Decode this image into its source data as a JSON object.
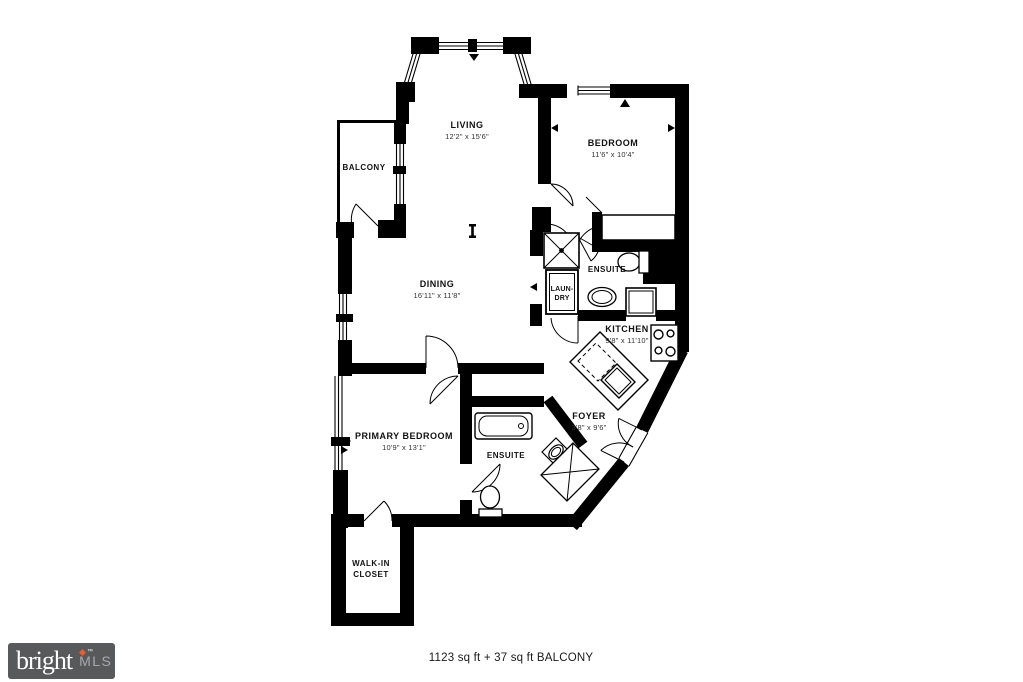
{
  "colors": {
    "wall": "#000000",
    "background": "#ffffff",
    "logo_bg": "#58595b",
    "logo_accent": "#ef5b2c",
    "logo_mls": "#a7a9ac"
  },
  "logo": {
    "brand": "bright",
    "tm": "™",
    "suffix": "MLS"
  },
  "footer": {
    "area_text": "1123 sq ft + 37 sq ft BALCONY"
  },
  "rooms": {
    "living": {
      "name": "LIVING",
      "dims": "12'2\" x 15'6\""
    },
    "balcony": {
      "name": "BALCONY"
    },
    "bedroom": {
      "name": "BEDROOM",
      "dims": "11'6\" x 10'4\""
    },
    "dining": {
      "name": "DINING",
      "dims": "16'11\" x 11'8\""
    },
    "ensuite_upper": {
      "name": "ENSUITE"
    },
    "laundry": {
      "name_line1": "LAUN-",
      "name_line2": "DRY"
    },
    "kitchen": {
      "name": "KITCHEN",
      "dims": "9'8\" x 11'10\""
    },
    "foyer": {
      "name": "FOYER",
      "dims": "3'8\" x 9'6\""
    },
    "primary_bedroom": {
      "name": "PRIMARY BEDROOM",
      "dims": "10'9\" x 13'1\""
    },
    "ensuite_primary": {
      "name": "ENSUITE"
    },
    "walkin_closet": {
      "name_line1": "WALK-IN",
      "name_line2": "CLOSET"
    }
  }
}
